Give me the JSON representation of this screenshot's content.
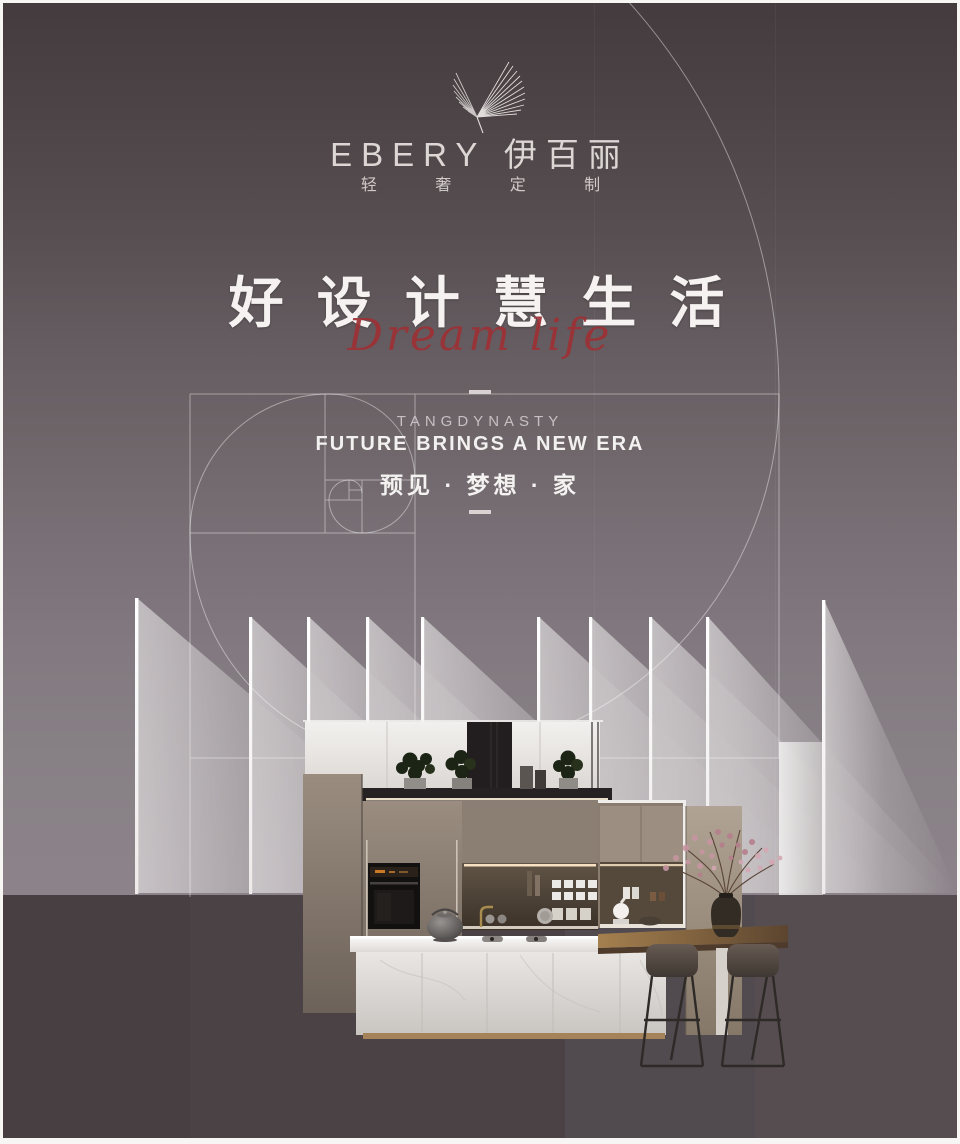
{
  "brand": {
    "logo_text": "EBERY 伊百丽",
    "tagline": "轻 奢 定 制",
    "wing_icon": "wing-feather-icon"
  },
  "hero": {
    "title": "好 设 计 慧 生 活",
    "script": "Dream life"
  },
  "section": {
    "eyebrow": "TANGDYNASTY",
    "headline": "FUTURE BRINGS A NEW ERA",
    "slogan": "预见 · 梦想 · 家"
  },
  "colors": {
    "bg_top": "#433b3d",
    "bg_light": "#8b8389",
    "band_dark": "#473f42",
    "accent_red": "#9d3136",
    "text_light": "#f3f1f0",
    "line_white": "rgba(255,255,255,0.4)",
    "toe_kick_gold": "#a5835a"
  },
  "scene": {
    "elements": [
      "golden-ratio-spiral",
      "light-bars",
      "wall-cabinets",
      "range-hood-shelf",
      "potted-plants",
      "built-in-oven",
      "shelf-niche",
      "kitchen-island",
      "gas-hob",
      "kettle",
      "bar-table",
      "blossom-vase",
      "bar-stools"
    ]
  }
}
